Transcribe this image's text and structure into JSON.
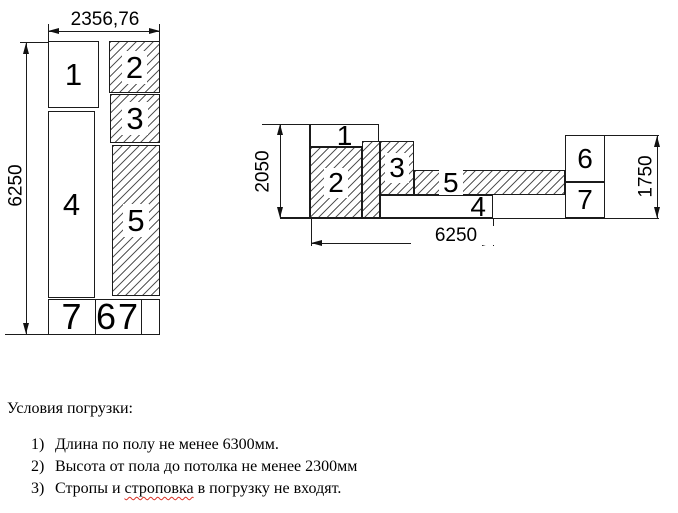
{
  "top_view": {
    "dim_width": "2356,76",
    "dim_height": "6250",
    "box1": "1",
    "box2": "2",
    "box3": "3",
    "box4": "4",
    "box5": "5",
    "row_left": "7",
    "row_mid_a": "6",
    "row_mid_b": "7"
  },
  "side_view": {
    "dim_height_left": "2050",
    "dim_height_right": "1750",
    "dim_length": "6250",
    "box1": "1",
    "box2": "2",
    "box3": "3",
    "box4": "4",
    "box5": "5",
    "box6": "6",
    "box7": "7"
  },
  "notes": {
    "heading": "Условия погрузки:",
    "items": [
      {
        "num": "1)",
        "text": "Длина по полу не менее 6300мм."
      },
      {
        "num": "2)",
        "text": "Высота от пола до потолка не менее 2300мм"
      },
      {
        "num": "3)",
        "text_before": "Стропы и ",
        "misspelled": "строповка",
        "text_after": " в погрузку не входят."
      }
    ]
  }
}
